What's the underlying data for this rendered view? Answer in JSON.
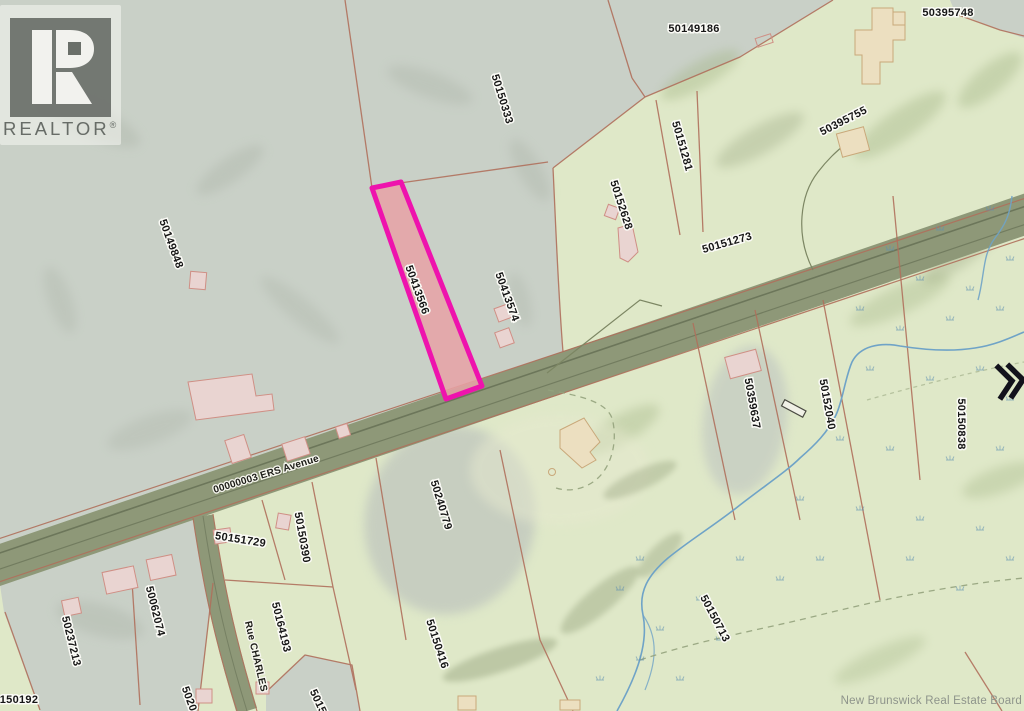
{
  "watermark": {
    "brand": "REALTOR",
    "reg": "®"
  },
  "attribution": "New Brunswick Real Estate Board",
  "highlighted_parcel": {
    "pid": "50413566",
    "fill": "#e8a2a6",
    "border": "#ee13ad"
  },
  "streets": [
    {
      "name": "00000003 ERS Avenue",
      "x": 267,
      "y": 477,
      "rot": -17
    },
    {
      "name": "Rue CHARLES",
      "x": 253,
      "y": 657,
      "rot": 77
    }
  ],
  "parcels": [
    {
      "pid": "50150333",
      "x": 499,
      "y": 100,
      "rot": 73
    },
    {
      "pid": "50149186",
      "x": 694,
      "y": 32,
      "rot": 0
    },
    {
      "pid": "50395748",
      "x": 948,
      "y": 16,
      "rot": 0
    },
    {
      "pid": "50395755",
      "x": 845,
      "y": 124,
      "rot": -27
    },
    {
      "pid": "50151281",
      "x": 679,
      "y": 147,
      "rot": 74
    },
    {
      "pid": "50152628",
      "x": 618,
      "y": 206,
      "rot": 72
    },
    {
      "pid": "50151273",
      "x": 728,
      "y": 246,
      "rot": -16
    },
    {
      "pid": "50149848",
      "x": 168,
      "y": 245,
      "rot": 70
    },
    {
      "pid": "50413566",
      "x": 414,
      "y": 291,
      "rot": 70
    },
    {
      "pid": "50413574",
      "x": 504,
      "y": 298,
      "rot": 70
    },
    {
      "pid": "50359637",
      "x": 749,
      "y": 404,
      "rot": 80
    },
    {
      "pid": "50152040",
      "x": 824,
      "y": 405,
      "rot": 80
    },
    {
      "pid": "50150838",
      "x": 958,
      "y": 424,
      "rot": 90
    },
    {
      "pid": "50240779",
      "x": 438,
      "y": 506,
      "rot": 73
    },
    {
      "pid": "50151729",
      "x": 240,
      "y": 543,
      "rot": 9
    },
    {
      "pid": "50150390",
      "x": 299,
      "y": 538,
      "rot": 80
    },
    {
      "pid": "50164193",
      "x": 278,
      "y": 628,
      "rot": 76
    },
    {
      "pid": "50062074",
      "x": 152,
      "y": 612,
      "rot": 76
    },
    {
      "pid": "50237213",
      "x": 68,
      "y": 642,
      "rot": 76
    },
    {
      "pid": "50150416",
      "x": 434,
      "y": 645,
      "rot": 72
    },
    {
      "pid": "50150713",
      "x": 712,
      "y": 620,
      "rot": 62
    },
    {
      "pid": "150192",
      "x": 19,
      "y": 703,
      "rot": 0
    },
    {
      "pid": "5020",
      "x": 186,
      "y": 700,
      "rot": 70
    },
    {
      "pid": "5015",
      "x": 315,
      "y": 703,
      "rot": 65
    }
  ],
  "controls": {
    "pan_right_icon": "double-chevron-right"
  },
  "colors": {
    "terrain_green": "#dfe8c8",
    "terrain_grey": "#c9d0c7",
    "parcel_line": "#b0705c",
    "road": "#8e9878",
    "water": "#6fa3c7",
    "highlight_border": "#ee13ad",
    "highlight_fill": "#e8a2a6"
  }
}
